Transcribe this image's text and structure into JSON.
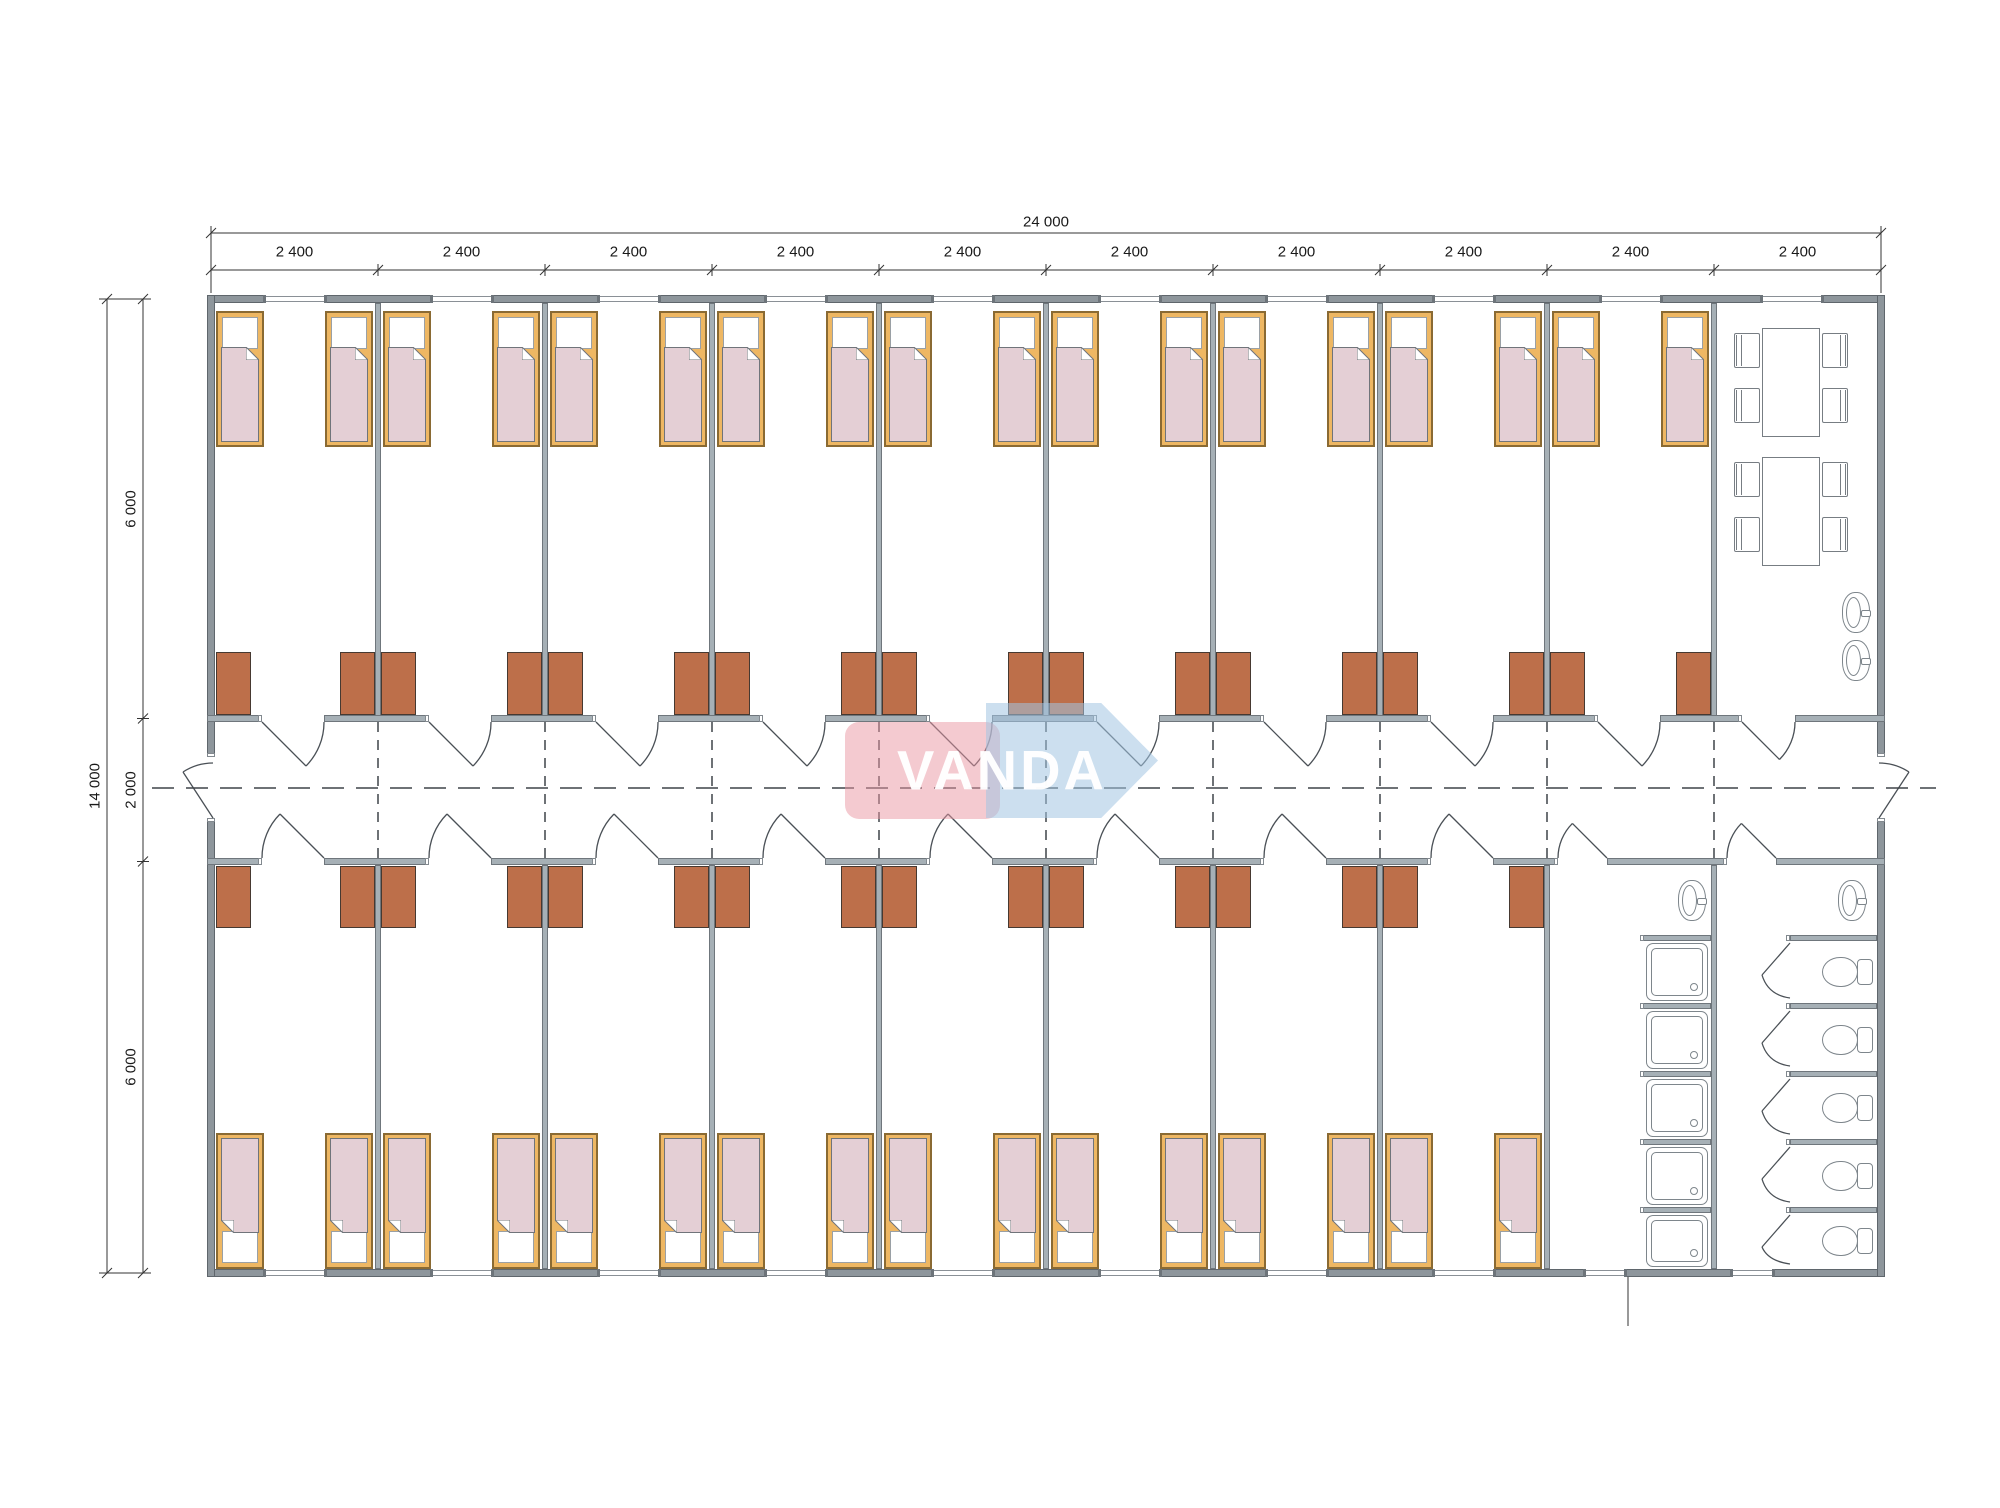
{
  "document": {
    "type": "architectural floor plan",
    "description": "Modular container dormitory plan: two rows of bedrooms along a central corridor, dining room top-right, shower and toilet rooms bottom-right"
  },
  "dimensions": {
    "overall_width": "24 000",
    "overall_height": "14 000",
    "module_widths": [
      "2 400",
      "2 400",
      "2 400",
      "2 400",
      "2 400",
      "2 400",
      "2 400",
      "2 400",
      "2 400",
      "2 400"
    ],
    "height_segments": [
      "6 000",
      "2 000",
      "6 000"
    ]
  },
  "logo": {
    "text": "VANDA"
  },
  "rooms": {
    "top_bedroom_modules": 9,
    "bottom_bedroom_modules": 8,
    "beds_top": 18,
    "beds_bottom": 16,
    "wardrobes_top": 18,
    "wardrobes_bottom": 16,
    "dining": {
      "tables": 2,
      "chairs": 8,
      "wash_basins": 2
    },
    "shower_room": {
      "shower_trays": 5,
      "wash_basins": 1
    },
    "toilet_room": {
      "toilets": 5,
      "wash_basins": 1
    }
  },
  "colors": {
    "wall_exterior": "#8e969c",
    "wall_interior": "#a6b0b6",
    "bed_frame": "#eeb763",
    "bed_blanket": "#e4cfd5",
    "wardrobe": "#bd6f4a",
    "fixture_line": "#7e868c",
    "drawing_line": "#4a5056",
    "dimension_line": "#333333",
    "logo_pink": "rgba(233,150,162,0.5)",
    "logo_blue": "rgba(163,196,226,0.55)",
    "logo_text": "#ffffff"
  }
}
